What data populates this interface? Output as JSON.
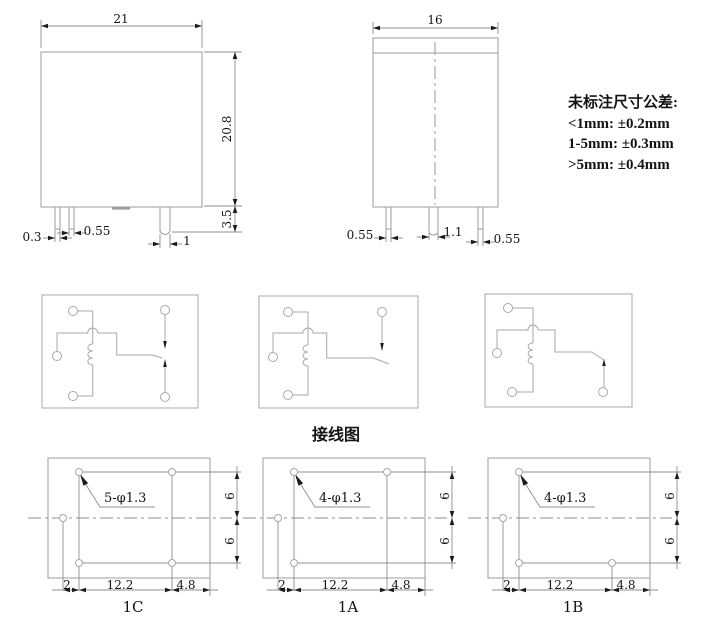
{
  "colors": {
    "bg": "#ffffff",
    "line": "#9d9d9d",
    "line2": "#a8a8a8",
    "dimline": "#8f8f8f",
    "arrow": "#1c1c1c",
    "text": "#141414"
  },
  "front_view": {
    "width_dim": "21",
    "height_dim": "20.8",
    "pin_len_dim": "3.5",
    "pin_dims": [
      "0.3",
      "0.55",
      "1"
    ]
  },
  "side_view": {
    "width_dim": "16",
    "pin_dims": [
      "0.55",
      "1.1",
      "0.55"
    ]
  },
  "tolerance_note": {
    "title": "未标注尺寸公差:",
    "rules": [
      "<1mm: ±0.2mm",
      "1-5mm: ±0.3mm",
      ">5mm: ±0.4mm"
    ]
  },
  "wiring_caption": "接线图",
  "layouts": [
    {
      "label": "1C",
      "hole_note": "5-φ1.3",
      "bottom_dims": [
        "2",
        "12.2",
        "4.8"
      ],
      "side_dims": [
        "6",
        "6"
      ]
    },
    {
      "label": "1A",
      "hole_note": "4-φ1.3",
      "bottom_dims": [
        "2",
        "12.2",
        "4.8"
      ],
      "side_dims": [
        "6",
        "6"
      ]
    },
    {
      "label": "1B",
      "hole_note": "4-φ1.3",
      "bottom_dims": [
        "2",
        "12.2",
        "4.8"
      ],
      "side_dims": [
        "6",
        "6"
      ]
    }
  ]
}
